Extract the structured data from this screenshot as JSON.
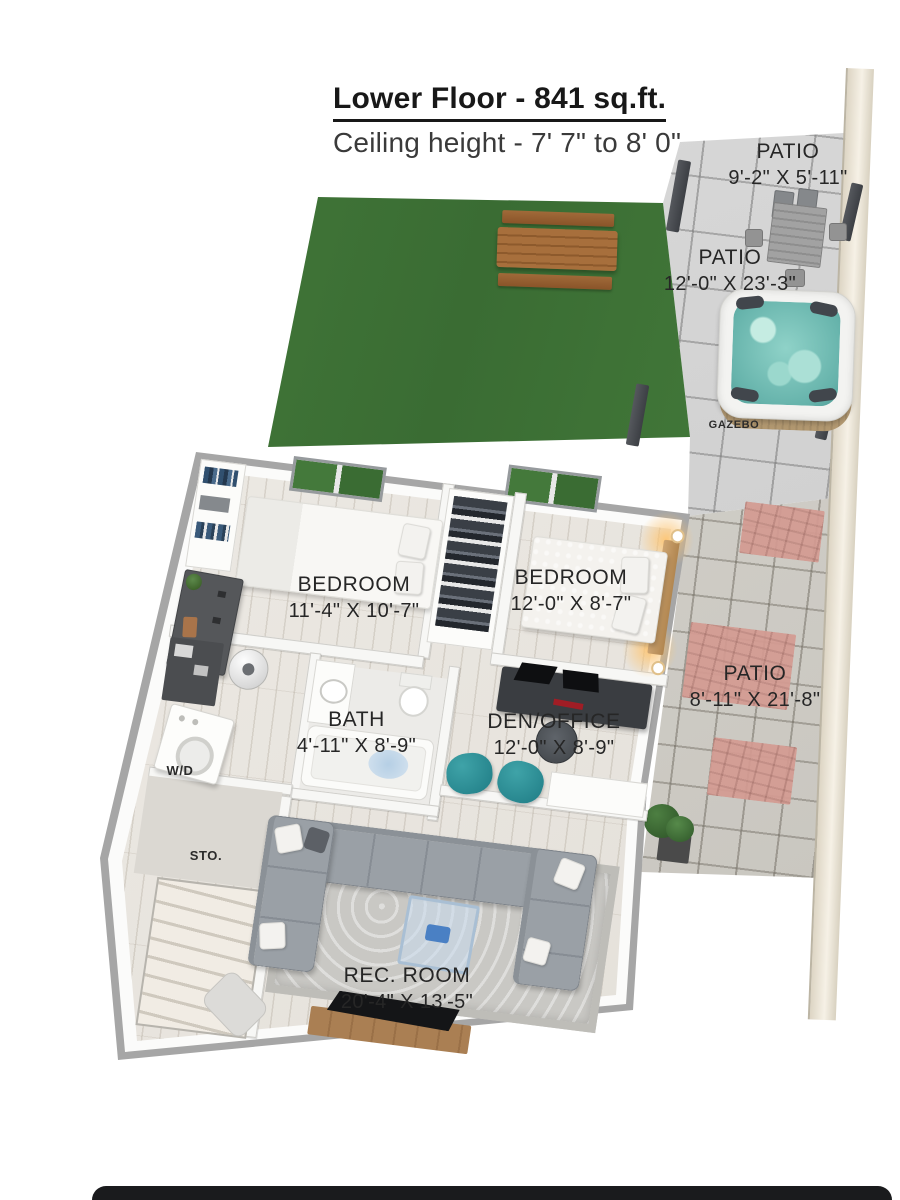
{
  "title": {
    "main": "Lower Floor - 841 sq.ft.",
    "sub": "Ceiling height - 7' 7\" to 8' 0\""
  },
  "labels": {
    "patio_top": {
      "name": "PATIO",
      "dims": "9'-2\" X 5'-11\""
    },
    "patio_mid": {
      "name": "PATIO",
      "dims": "12'-0\" X 23'-3\""
    },
    "gazebo": {
      "name": "GAZEBO"
    },
    "bedroom_left": {
      "name": "BEDROOM",
      "dims": "11'-4\" X 10'-7\""
    },
    "bedroom_right": {
      "name": "BEDROOM",
      "dims": "12'-0\" X 8'-7\""
    },
    "patio_side": {
      "name": "PATIO",
      "dims": "8'-11\" X 21'-8\""
    },
    "bath": {
      "name": "BATH",
      "dims": "4'-11\" X 8'-9\""
    },
    "den": {
      "name": "DEN/OFFICE",
      "dims": "12'-0\" X 8'-9\""
    },
    "wd": {
      "name": "W/D"
    },
    "sto": {
      "name": "STO."
    },
    "rec": {
      "name": "REC. ROOM",
      "dims": "20'-4\" X 13'-5\""
    }
  },
  "colors": {
    "grass": "#417637",
    "patio_tile": "#d2d0ca",
    "brick_accent": "#d49b92",
    "hot_tub_water": "#8fd2c8",
    "sofa_gray": "#9aa0a6",
    "bean_bag_teal": "#2a8d94",
    "picnic_wood": "#9c6535",
    "console_wood": "#aa7f53",
    "floor_wood": "#eae6e0",
    "wall_white": "#fbfbfa",
    "label_text": "#262626",
    "bottom_bar": "#1a1b1d"
  }
}
